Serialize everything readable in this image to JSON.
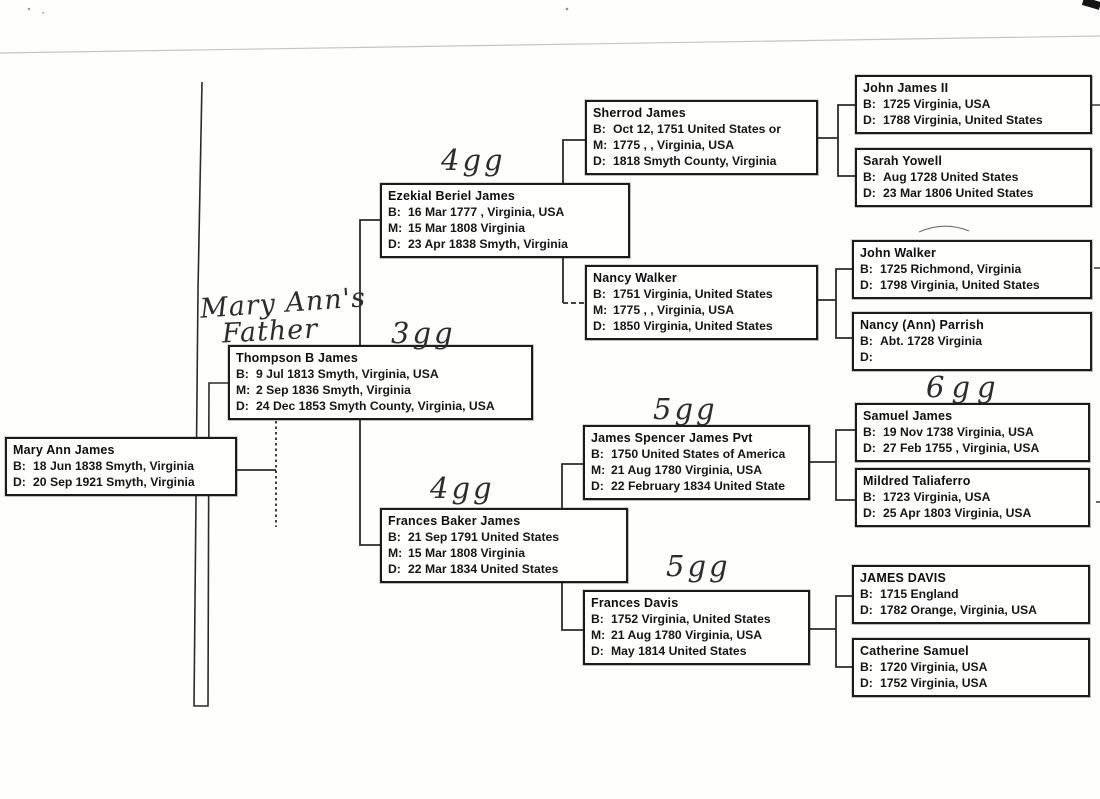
{
  "document": {
    "type": "scanned pedigree chart",
    "paper_color": "#fefefd",
    "ink_color": "#1b1b1b"
  },
  "annotations": {
    "owner_note": {
      "line1": "Mary Ann's",
      "line2": "Father"
    },
    "generation_labels": [
      "4gg",
      "3gg",
      "5gg",
      "4gg",
      "5gg",
      "6gg"
    ]
  },
  "people": [
    {
      "name": "Mary Ann James",
      "lines": [
        {
          "label": "B:",
          "value": "18 Jun 1838 Smyth, Virginia"
        },
        {
          "label": "D:",
          "value": "20 Sep 1921 Smyth, Virginia"
        }
      ]
    },
    {
      "name": "Thompson B James",
      "lines": [
        {
          "label": "B:",
          "value": "9 Jul 1813 Smyth, Virginia, USA"
        },
        {
          "label": "M:",
          "value": "2 Sep 1836 Smyth, Virginia"
        },
        {
          "label": "D:",
          "value": "24 Dec 1853 Smyth County, Virginia, USA"
        }
      ]
    },
    {
      "name": "Ezekial Beriel James",
      "lines": [
        {
          "label": "B:",
          "value": "16 Mar 1777 , Virginia, USA"
        },
        {
          "label": "M:",
          "value": "15 Mar 1808 Virginia"
        },
        {
          "label": "D:",
          "value": "23 Apr 1838 Smyth, Virginia"
        }
      ]
    },
    {
      "name": "Sherrod James",
      "lines": [
        {
          "label": "B:",
          "value": "Oct 12, 1751 United States or"
        },
        {
          "label": "M:",
          "value": "1775 , , Virginia, USA"
        },
        {
          "label": "D:",
          "value": "1818 Smyth County, Virginia"
        }
      ]
    },
    {
      "name": "John James II",
      "lines": [
        {
          "label": "B:",
          "value": "1725 Virginia, USA"
        },
        {
          "label": "D:",
          "value": "1788 Virginia, United States"
        }
      ]
    },
    {
      "name": "Sarah Yowell",
      "lines": [
        {
          "label": "B:",
          "value": "Aug 1728 United States"
        },
        {
          "label": "D:",
          "value": "23 Mar 1806 United States"
        }
      ]
    },
    {
      "name": "Nancy Walker",
      "lines": [
        {
          "label": "B:",
          "value": "1751 Virginia, United States"
        },
        {
          "label": "M:",
          "value": "1775 , , Virginia, USA"
        },
        {
          "label": "D:",
          "value": "1850 Virginia, United States"
        }
      ]
    },
    {
      "name": "John Walker",
      "lines": [
        {
          "label": "B:",
          "value": "1725 Richmond, Virginia"
        },
        {
          "label": "D:",
          "value": "1798 Virginia, United States"
        }
      ]
    },
    {
      "name": "Nancy (Ann) Parrish",
      "lines": [
        {
          "label": "B:",
          "value": "Abt. 1728 Virginia"
        },
        {
          "label": "D:",
          "value": ""
        }
      ]
    },
    {
      "name": "James Spencer James Pvt",
      "lines": [
        {
          "label": "B:",
          "value": "1750 United States of America"
        },
        {
          "label": "M:",
          "value": "21 Aug 1780 Virginia, USA"
        },
        {
          "label": "D:",
          "value": "22 February 1834 United State"
        }
      ]
    },
    {
      "name": "Samuel James",
      "lines": [
        {
          "label": "B:",
          "value": "19 Nov 1738 Virginia, USA"
        },
        {
          "label": "D:",
          "value": "27 Feb 1755 , Virginia, USA"
        }
      ]
    },
    {
      "name": "Mildred Taliaferro",
      "lines": [
        {
          "label": "B:",
          "value": "1723 Virginia, USA"
        },
        {
          "label": "D:",
          "value": "25 Apr 1803 Virginia, USA"
        }
      ]
    },
    {
      "name": "Frances Baker James",
      "lines": [
        {
          "label": "B:",
          "value": "21 Sep 1791 United States"
        },
        {
          "label": "M:",
          "value": "15 Mar 1808 Virginia"
        },
        {
          "label": "D:",
          "value": "22 Mar 1834 United States"
        }
      ]
    },
    {
      "name": "Frances Davis",
      "lines": [
        {
          "label": "B:",
          "value": "1752 Virginia, United States"
        },
        {
          "label": "M:",
          "value": "21 Aug 1780 Virginia, USA"
        },
        {
          "label": "D:",
          "value": "May 1814 United States"
        }
      ]
    },
    {
      "name": "JAMES DAVIS",
      "lines": [
        {
          "label": "B:",
          "value": "1715 England"
        },
        {
          "label": "D:",
          "value": "1782 Orange, Virginia, USA"
        }
      ]
    },
    {
      "name": "Catherine Samuel",
      "lines": [
        {
          "label": "B:",
          "value": "1720 Virginia, USA"
        },
        {
          "label": "D:",
          "value": "1752 Virginia, USA"
        }
      ]
    }
  ]
}
